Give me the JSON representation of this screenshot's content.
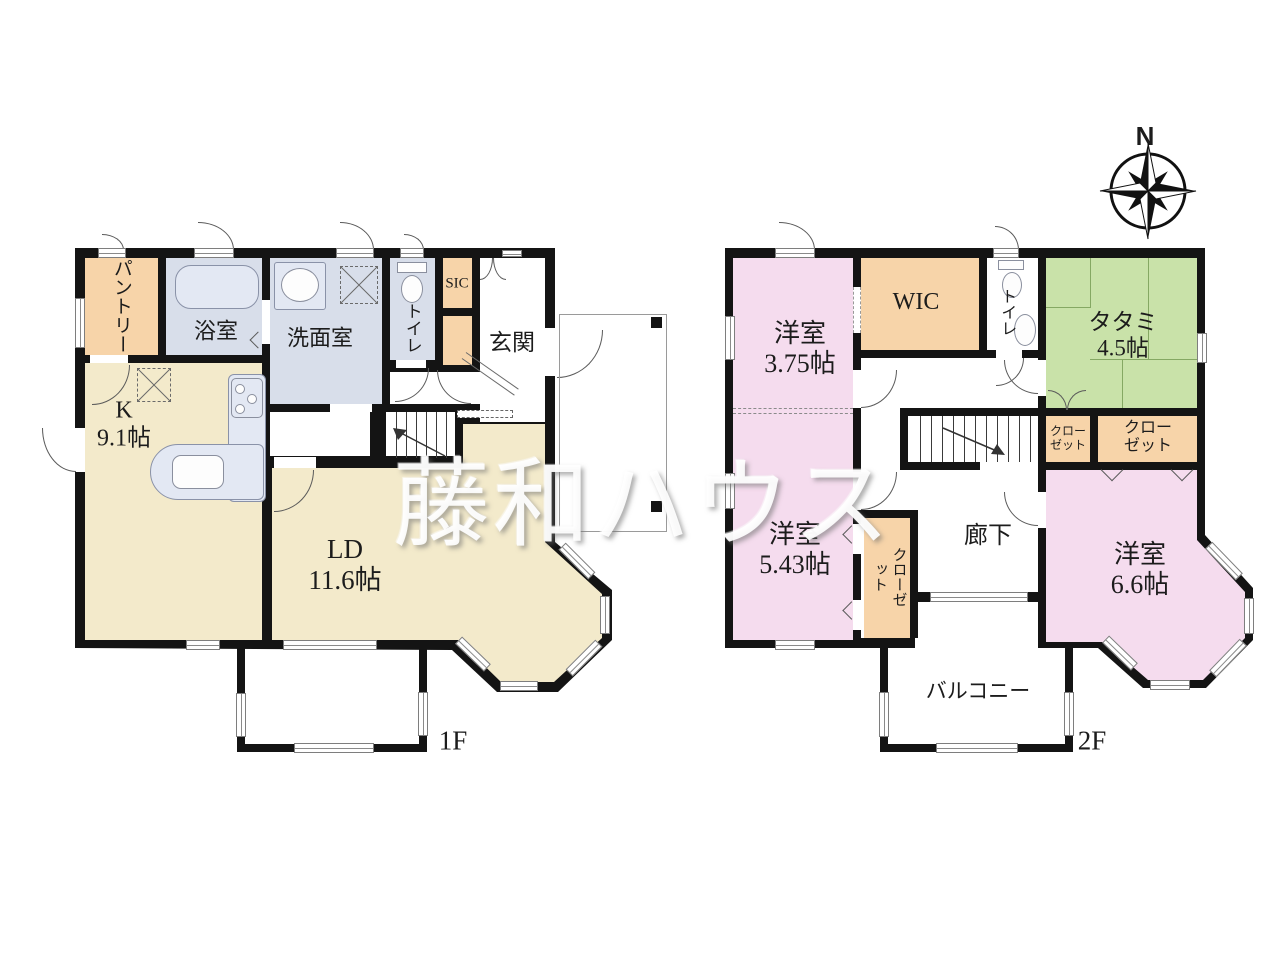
{
  "watermark": "藤和ハウス",
  "compass": {
    "north": "N"
  },
  "colors": {
    "wall": "#141414",
    "ld": "#F3EACB",
    "wet": "#D8DEEA",
    "storage": "#F7D4A9",
    "bedroom": "#F5DCEE",
    "tatami": "#C9E2A9"
  },
  "f1": {
    "floor": "1F",
    "pantry": "パントリー",
    "bath": "浴室",
    "washroom": "洗面室",
    "toilet": "トイレ",
    "sic": "SIC",
    "entrance": "玄関",
    "kitchen_name": "K",
    "kitchen_size": "9.1帖",
    "ld_name": "LD",
    "ld_size": "11.6帖"
  },
  "f2": {
    "floor": "2F",
    "bed1_name": "洋室",
    "bed1_size": "3.75帖",
    "wic": "WIC",
    "toilet": "トイレ",
    "tatami_name": "タタミ",
    "tatami_size": "4.5帖",
    "closet_a_l1": "クロー",
    "closet_a_l2": "ゼット",
    "closet_b_l1": "クロー",
    "closet_b_l2": "ゼット",
    "bed2_name": "洋室",
    "bed2_size": "5.43帖",
    "closet_c": "クローゼット",
    "hallway": "廊下",
    "bed3_name": "洋室",
    "bed3_size": "6.6帖",
    "balcony": "バルコニー"
  }
}
